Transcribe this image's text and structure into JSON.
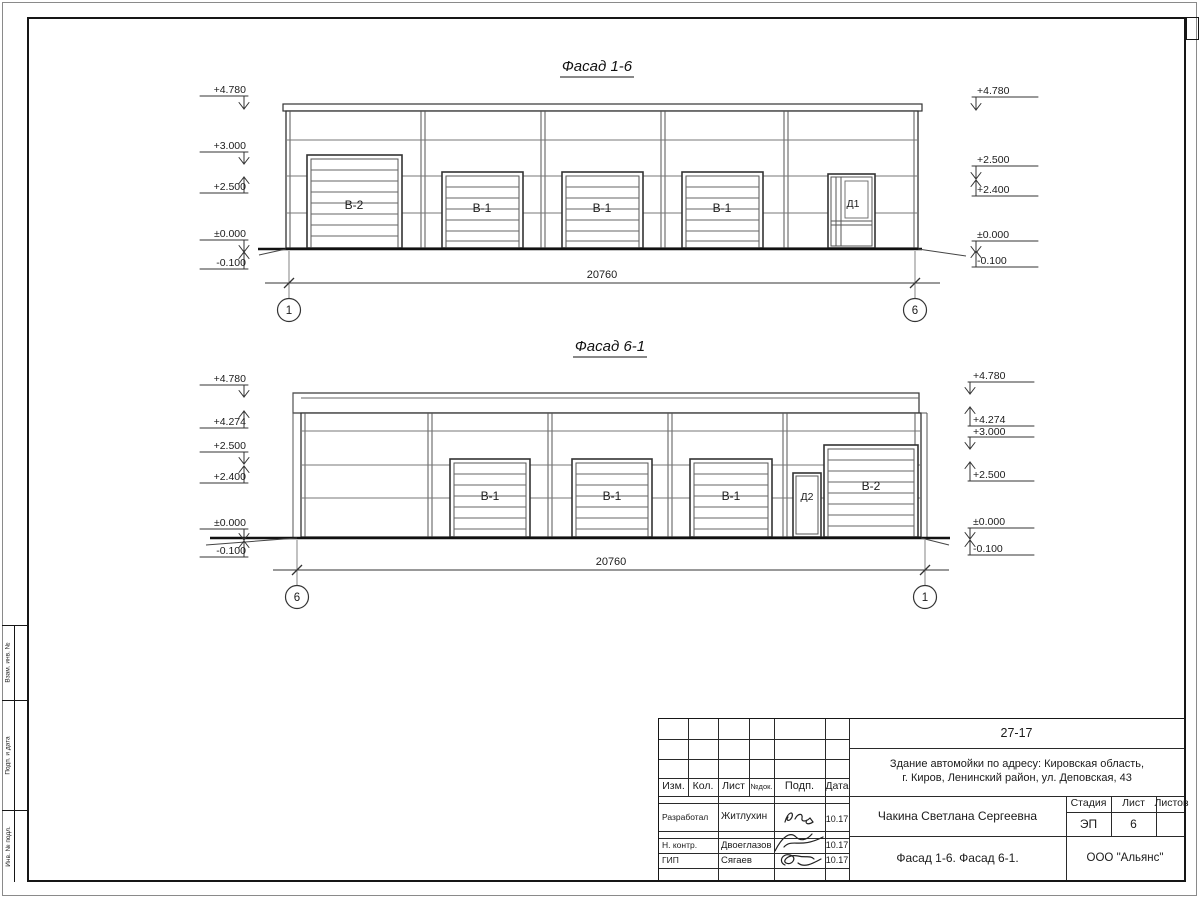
{
  "sheet": {
    "side_labels": [
      "Взам. инв. №",
      "Подп. и дата",
      "Инв. № подл."
    ]
  },
  "facade_top": {
    "title": "Фасад 1-6",
    "dimension": "20760",
    "axis_left": "1",
    "axis_right": "6",
    "door_labels": [
      "В-2",
      "В-1",
      "В-1",
      "В-1",
      "Д1"
    ],
    "marks_left": [
      "+4.780",
      "+3.000",
      "+2.500",
      "±0.000",
      "-0.100"
    ],
    "marks_right": [
      "+4.780",
      "+2.500",
      "+2.400",
      "±0.000",
      "-0.100"
    ]
  },
  "facade_bottom": {
    "title": "Фасад 6-1",
    "dimension": "20760",
    "axis_left": "6",
    "axis_right": "1",
    "door_labels": [
      "В-1",
      "В-1",
      "В-1",
      "Д2",
      "В-2"
    ],
    "marks_left": [
      "+4.780",
      "+4.274",
      "+2.500",
      "+2.400",
      "±0.000",
      "-0.100"
    ],
    "marks_right": [
      "+4.780",
      "+4.274",
      "+3.000",
      "+2.500",
      "±0.000",
      "-0.100"
    ]
  },
  "title_block": {
    "code": "27-17",
    "address_line1": "Здание автомойки по адресу: Кировская область,",
    "address_line2": "г. Киров, Ленинский район, ул. Деповская, 43",
    "columns": {
      "izm": "Изм.",
      "kol": "Кол.",
      "list": "Лист",
      "ndok": "№док.",
      "podp": "Подп.",
      "data": "Дата"
    },
    "signature_rows": {
      "developer": {
        "role": "Разработал",
        "name": "Житлухин",
        "date": "10.17"
      },
      "normcontrol": {
        "role": "Н. контр.",
        "name": "Двоеглазов",
        "date": "10.17"
      },
      "gip": {
        "role": "ГИП",
        "name": "Сягаев",
        "date": "10.17"
      }
    },
    "designer": "Чакина Светлана Сергеевна",
    "stage_label": "Стадия",
    "list_label": "Лист",
    "listov_label": "Листов",
    "stage": "ЭП",
    "sheet_number": "6",
    "sheets_total": "",
    "drawing_name": "Фасад 1-6. Фасад 6-1.",
    "company": "ООО \"Альянс\""
  }
}
